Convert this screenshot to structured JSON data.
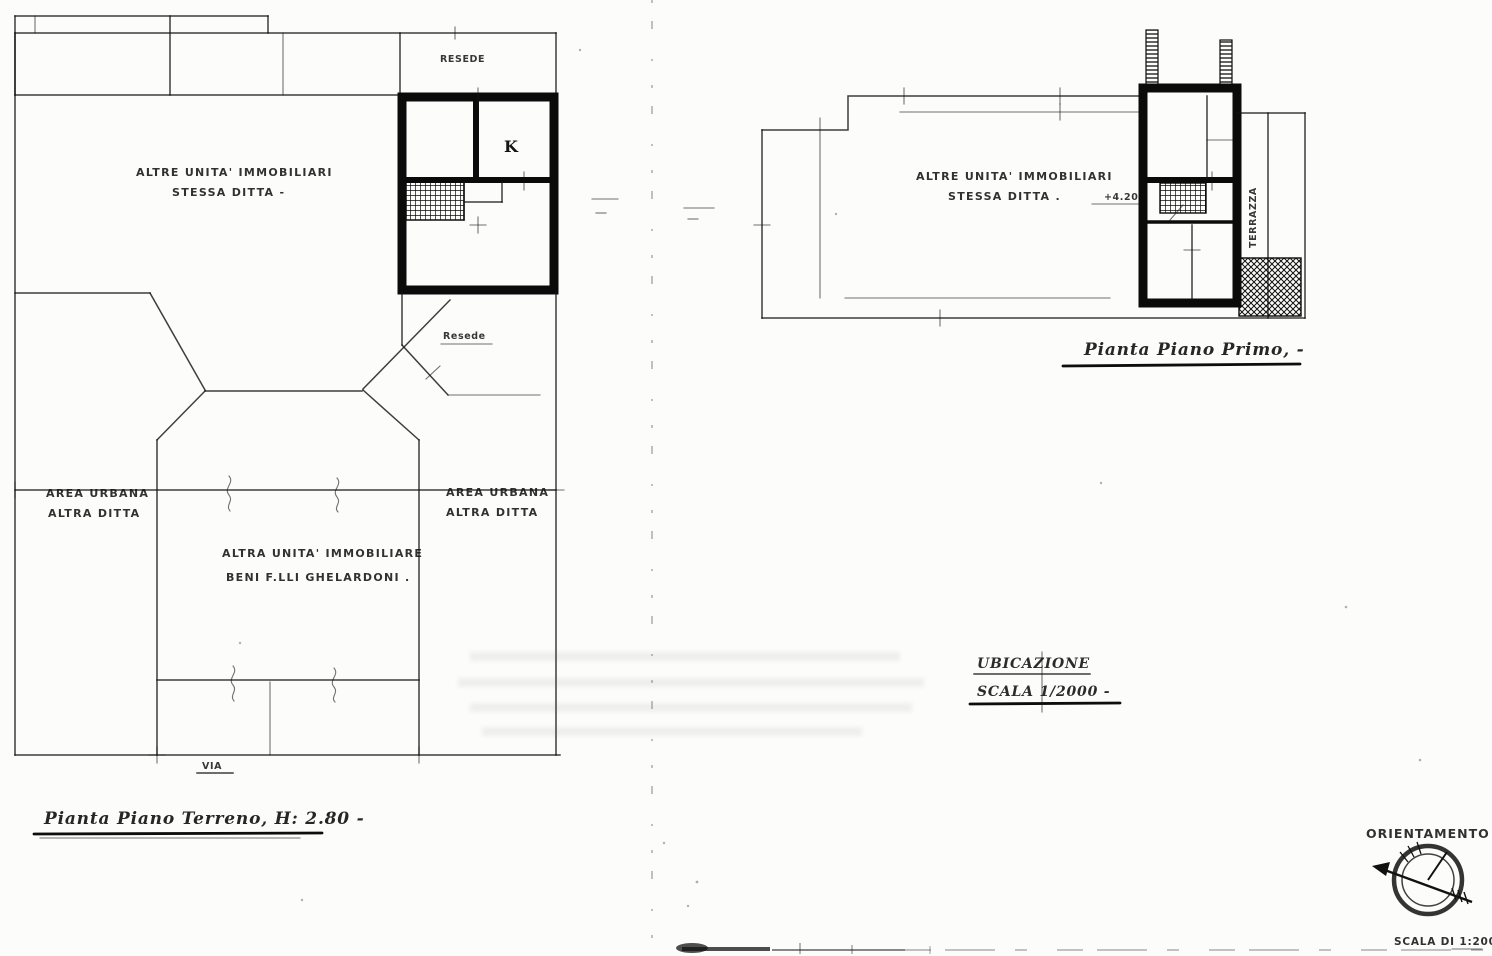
{
  "drawing": {
    "ink_color": "#141414",
    "paper_color": "#fcfcfa",
    "ground_floor": {
      "title": "Pianta Piano Terreno, H: 2.80 -",
      "other_units_line1": "ALTRE  UNITA'  IMMOBILIARI",
      "other_units_line2": "STESSA  DITTA -",
      "yard_top_label": "RESEDE",
      "kitchen_label": "K",
      "yard_side_label": "Resede",
      "area_left_line1": "AREA  URBANA",
      "area_left_line2": "ALTRA  DITTA",
      "area_right_line1": "AREA  URBANA",
      "area_right_line2": "ALTRA  DITTA",
      "central_line1": "ALTRA  UNITA'  IMMOBILIARE",
      "central_line2": "BENI  F.LLI  GHELARDONI .",
      "street_label": "VIA"
    },
    "first_floor": {
      "title": "Pianta Piano Primo, -",
      "other_units_line1": "ALTRE  UNITA'  IMMOBILIARI",
      "other_units_line2": "STESSA  DITTA .",
      "elevation_label": "+4.20",
      "terrace_label": "TERRAZZA"
    },
    "location_note": {
      "line1": "UBICAZIONE",
      "line2": "SCALA 1/2000 -"
    },
    "orientation": {
      "title": "ORIENTAMENTO",
      "scale_label": "SCALA DI 1:200"
    }
  }
}
